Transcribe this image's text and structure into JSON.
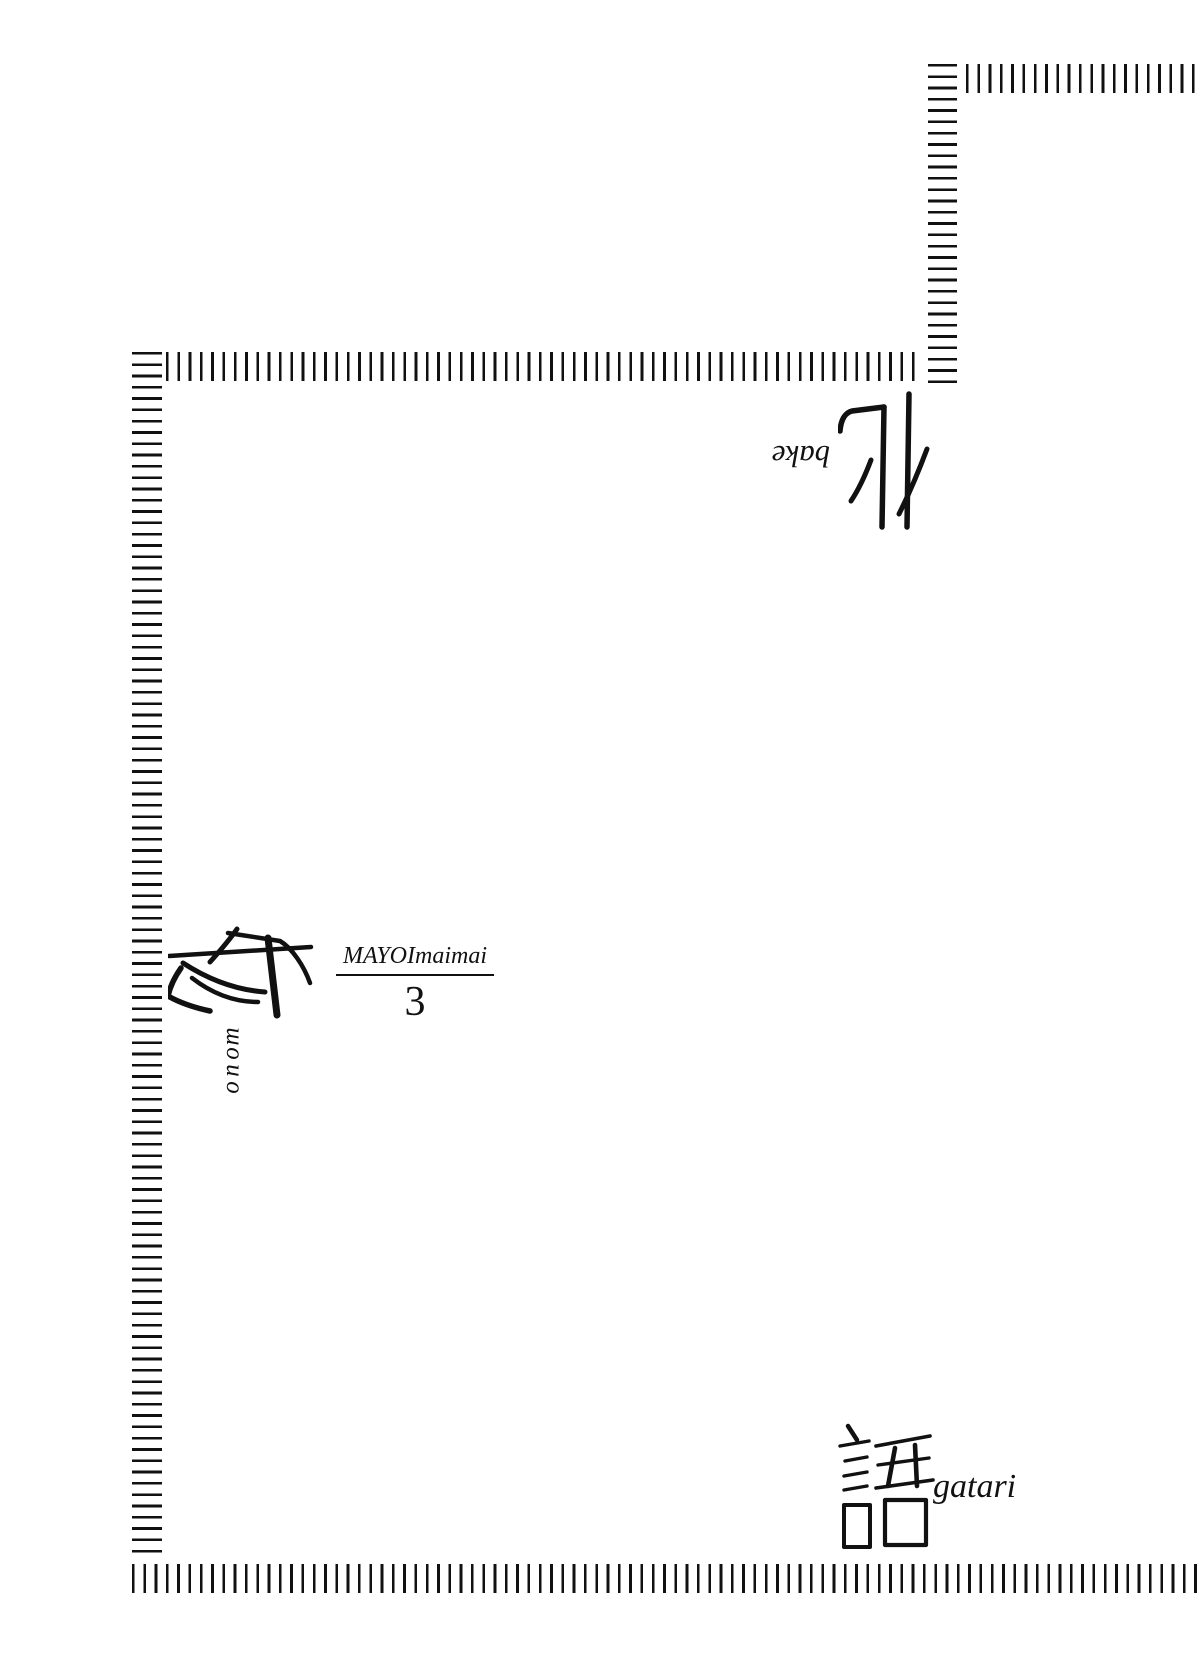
{
  "page": {
    "background": "#ffffff",
    "ink": "#111111"
  },
  "wordmark": {
    "bake": {
      "kanji": "化",
      "romaji": "bake",
      "rotated_180": true
    },
    "mono": {
      "kanji": "物",
      "romaji": "mono",
      "rotated_180": true
    },
    "gatari": {
      "kanji": "語",
      "romaji": "gatari",
      "rotated_180": false
    }
  },
  "chapter": {
    "series_romaji": "MAYOImaimai",
    "number": "3"
  }
}
